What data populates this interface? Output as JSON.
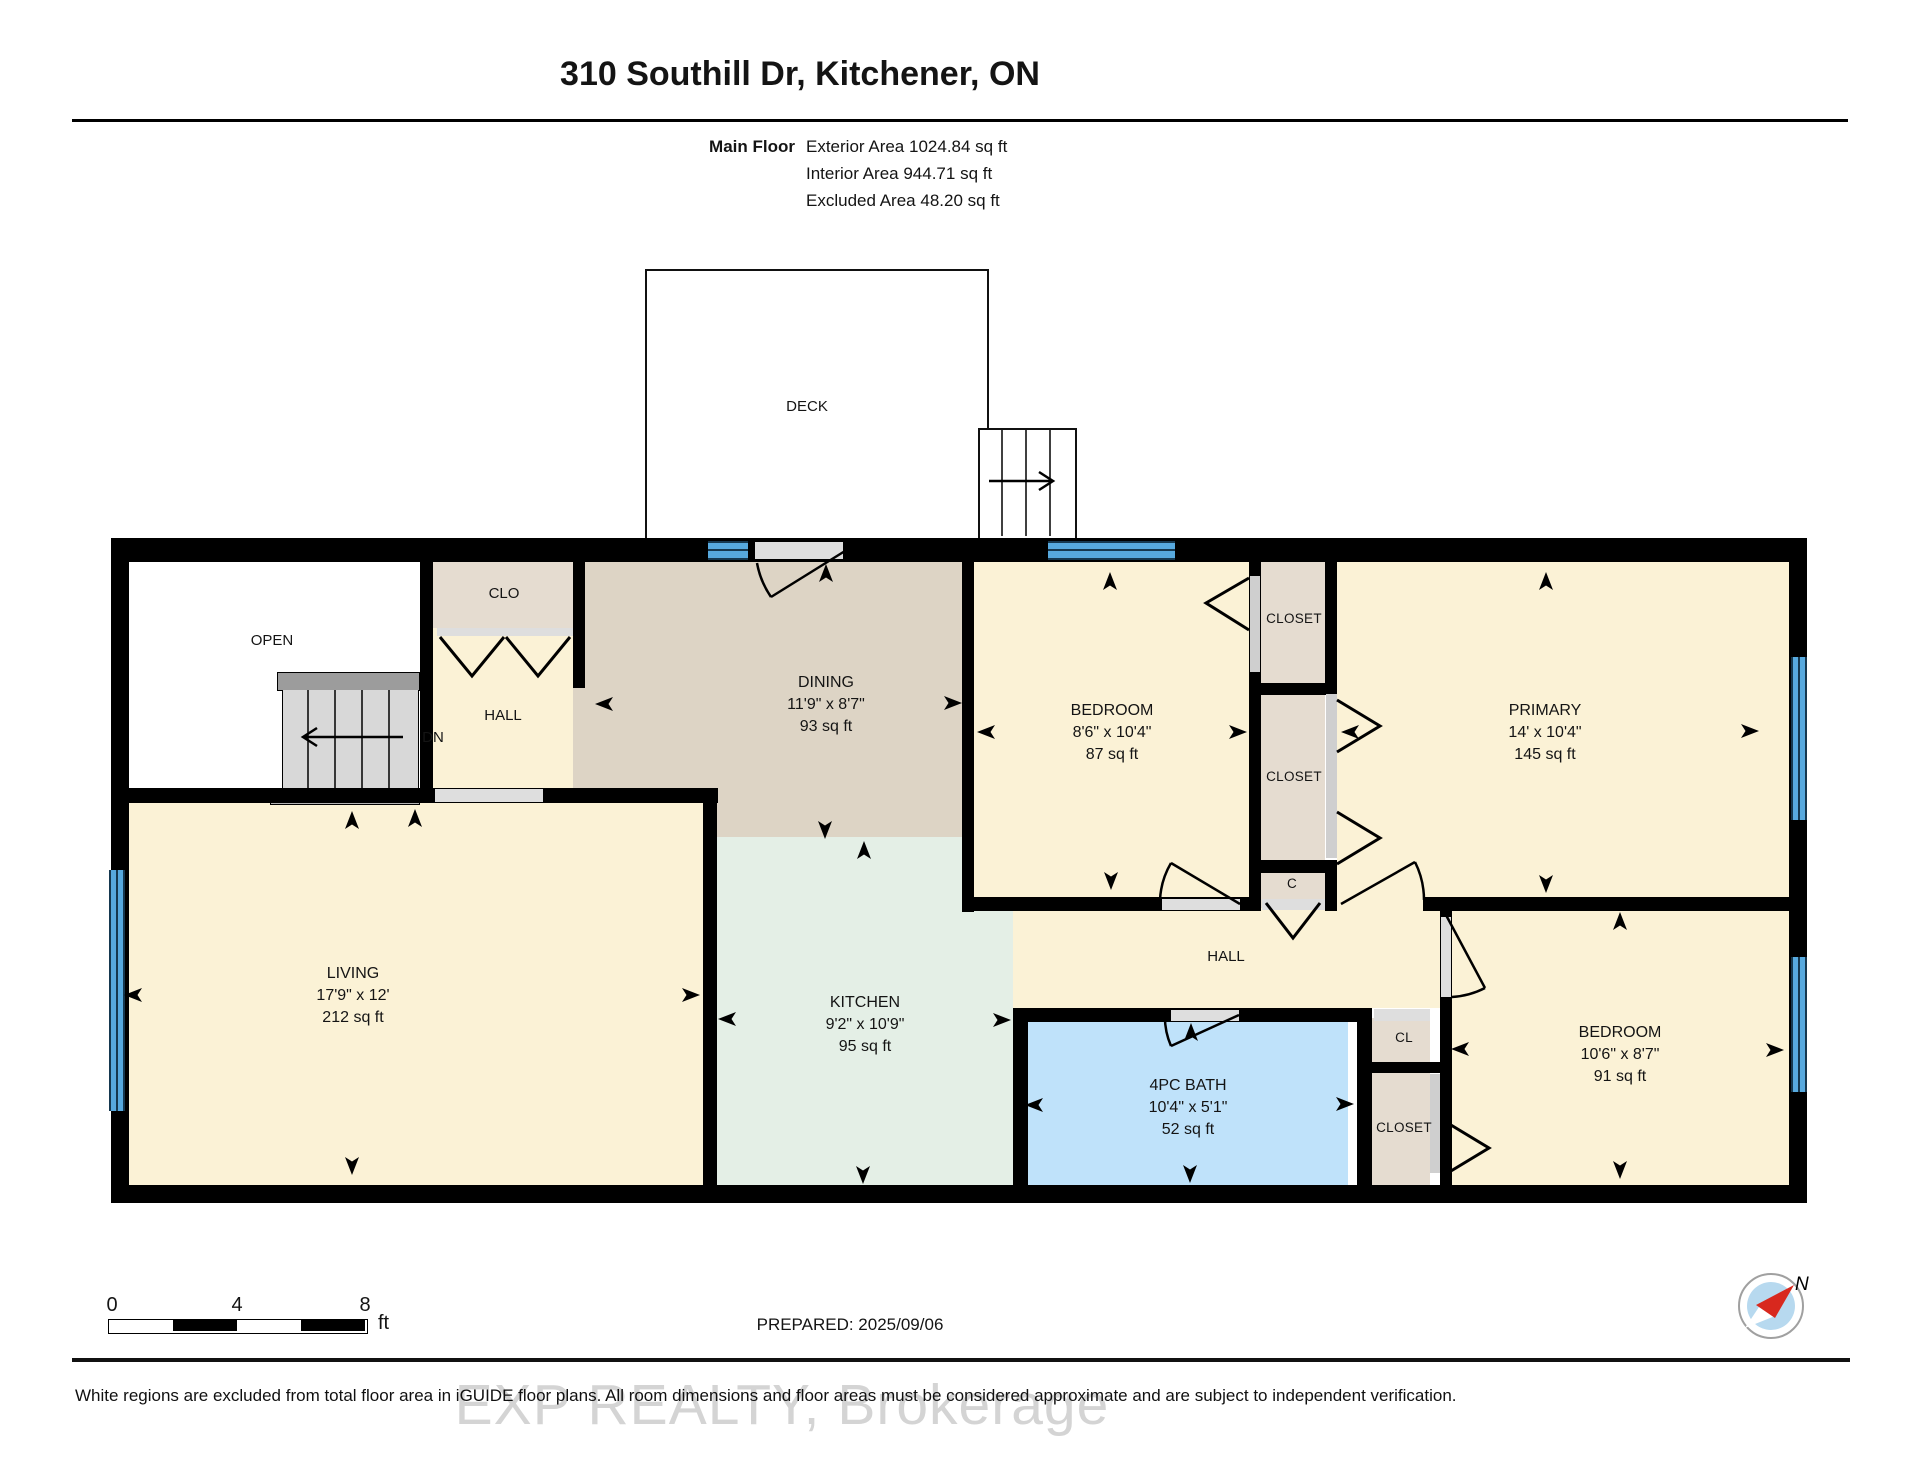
{
  "header": {
    "title": "310 Southill Dr, Kitchener, ON",
    "floor_label": "Main Floor",
    "areas": [
      {
        "label": "Exterior Area",
        "value": "1024.84 sq ft"
      },
      {
        "label": "Interior Area",
        "value": "944.71 sq ft"
      },
      {
        "label": "Excluded Area",
        "value": "48.20 sq ft"
      }
    ]
  },
  "rooms": {
    "living": {
      "name": "LIVING",
      "dims": "17'9\" x 12'",
      "area": "212 sq ft"
    },
    "dining": {
      "name": "DINING",
      "dims": "11'9\" x 8'7\"",
      "area": "93 sq ft"
    },
    "kitchen": {
      "name": "KITCHEN",
      "dims": "9'2\" x 10'9\"",
      "area": "95 sq ft"
    },
    "bath": {
      "name": "4PC BATH",
      "dims": "10'4\" x 5'1\"",
      "area": "52 sq ft"
    },
    "bedroom_top": {
      "name": "BEDROOM",
      "dims": "8'6\" x 10'4\"",
      "area": "87 sq ft"
    },
    "primary": {
      "name": "PRIMARY",
      "dims": "14' x 10'4\"",
      "area": "145 sq ft"
    },
    "bedroom_right": {
      "name": "BEDROOM",
      "dims": "10'6\" x 8'7\"",
      "area": "91 sq ft"
    },
    "deck": {
      "name": "DECK"
    },
    "open": {
      "name": "OPEN"
    },
    "hall_upper": {
      "name": "HALL"
    },
    "hall_lower": {
      "name": "HALL"
    },
    "clo": {
      "name": "CLO"
    },
    "closet_bedroom_top": {
      "name": "CLOSET"
    },
    "closet_primary": {
      "name": "CLOSET"
    },
    "closet_c": {
      "name": "C"
    },
    "cl": {
      "name": "CL"
    },
    "closet_bedroom_right": {
      "name": "CLOSET"
    },
    "stairs_label": "DN"
  },
  "scale_bar": {
    "ticks": [
      "0",
      "4",
      "8"
    ],
    "unit": "ft"
  },
  "compass": {
    "north_label": "N"
  },
  "footer": {
    "prepared": "PREPARED: 2025/09/06",
    "watermark": "EXP REALTY, Brokerage",
    "disclaimer": "White regions are excluded from total floor area in iGUIDE floor plans. All room dimensions and floor areas must be considered approximate and are subject to independent verification."
  },
  "colors": {
    "wall": "#000000",
    "room_cream": "#fbf2d6",
    "dining_tan": "#ddd4c5",
    "kitchen_green": "#e4efe6",
    "bath_blue": "#bfe2fa",
    "closet_beige": "#e5dcd0",
    "window_blue": "#57a9de",
    "stair_gray": "#d8d8d8"
  }
}
